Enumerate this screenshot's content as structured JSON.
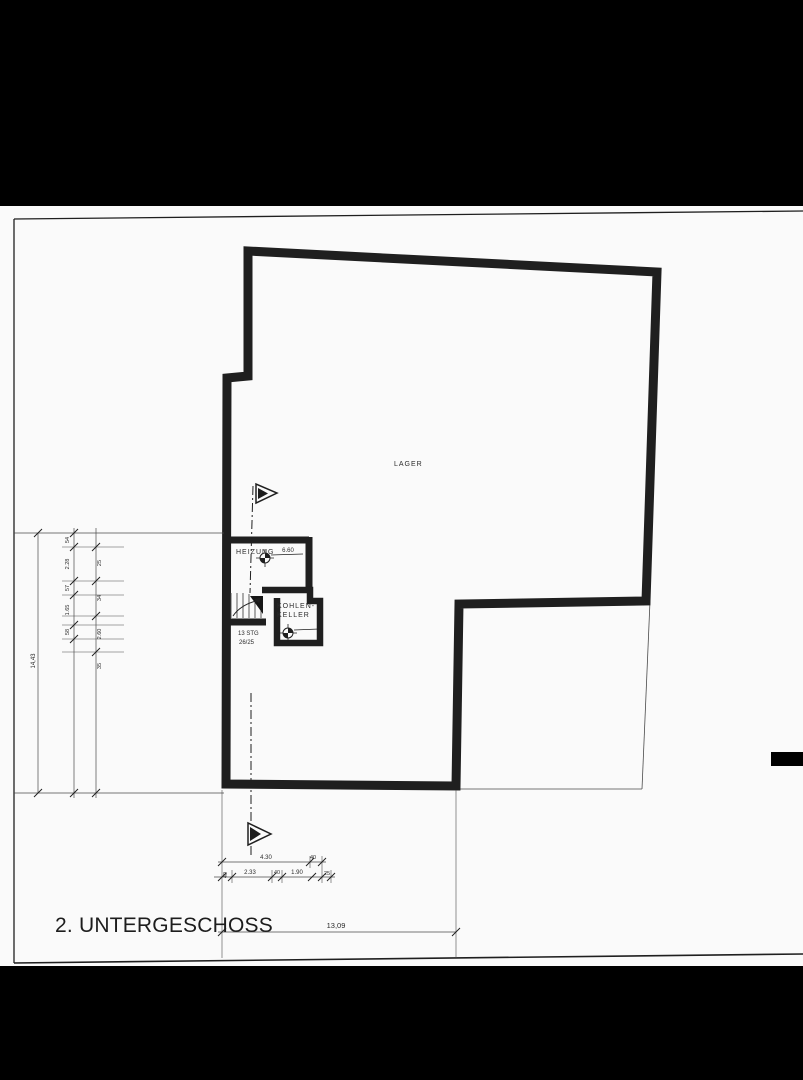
{
  "drawing": {
    "title": "2. UNTERGESCHOSS",
    "rooms": {
      "lager": "LAGER",
      "heizung": "HEIZUNG",
      "kohlenkeller_line1": "KOHLEN-",
      "kohlenkeller_line2": "KELLER",
      "stairs_line1": "13 STG",
      "stairs_line2": "26/25",
      "level_value": "6.60"
    },
    "dims": {
      "left_total": "14,43",
      "left_col_a": [
        "54",
        "2.28",
        "57",
        "1.65",
        "58"
      ],
      "left_col_b": [
        "25",
        "34",
        "2.60",
        "35"
      ],
      "bottom_row1": [
        "4.30",
        "40"
      ],
      "bottom_row2": [
        "40",
        "2.33",
        "40",
        "1.90",
        "25"
      ],
      "bottom_total": "13,09"
    },
    "colors": {
      "ink": "#1f1f1f",
      "paper": "#fafafa",
      "band": "#000000"
    }
  }
}
